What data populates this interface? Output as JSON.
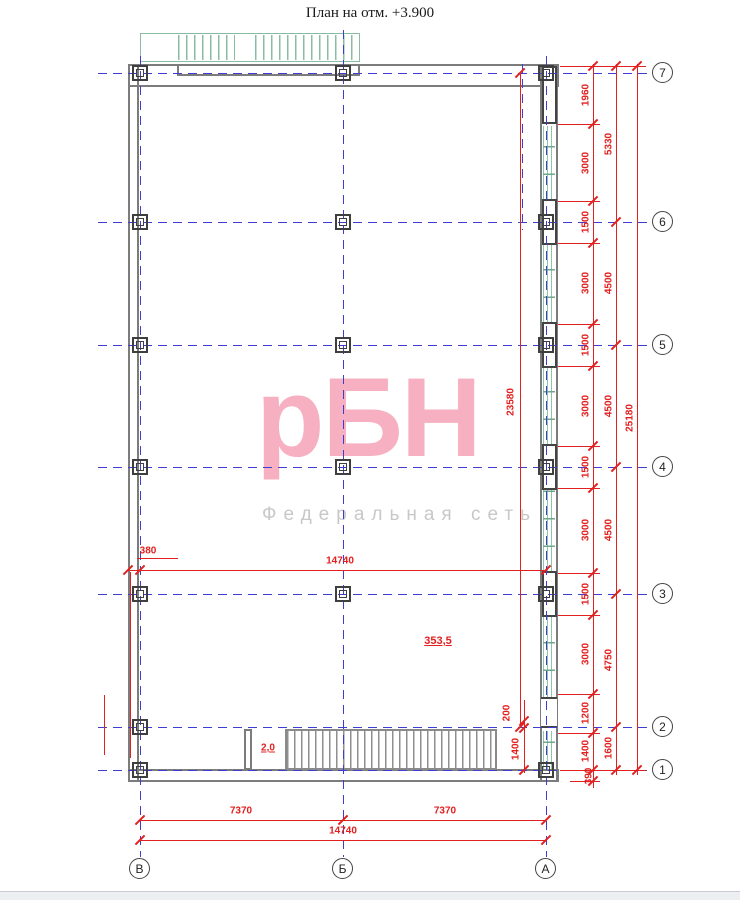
{
  "title": "План на отм. +3.900",
  "watermark": {
    "logo": "рБН",
    "subtitle": "Федеральная сеть"
  },
  "grid": {
    "rows": [
      "7",
      "6",
      "5",
      "4",
      "3",
      "2",
      "1"
    ],
    "cols": [
      "В",
      "Б",
      "А"
    ]
  },
  "labels": {
    "area": "353,5",
    "slope": "2,0"
  },
  "dims": {
    "right_tier1": [
      "1960",
      "3000",
      "1500",
      "3000",
      "1500",
      "3000",
      "1500",
      "3000",
      "1500",
      "3000",
      "1200",
      "1400",
      "390"
    ],
    "right_tier2": [
      "5330",
      "4500",
      "4500",
      "4500",
      "4750",
      "1600"
    ],
    "right_total": "25180",
    "right_inner": "23580",
    "dock_width": "200",
    "dock_height": "1400",
    "wall_offset": "380",
    "interior_width": "14740",
    "bottom_spans": [
      "7370",
      "7370"
    ],
    "bottom_total": "14740"
  }
}
